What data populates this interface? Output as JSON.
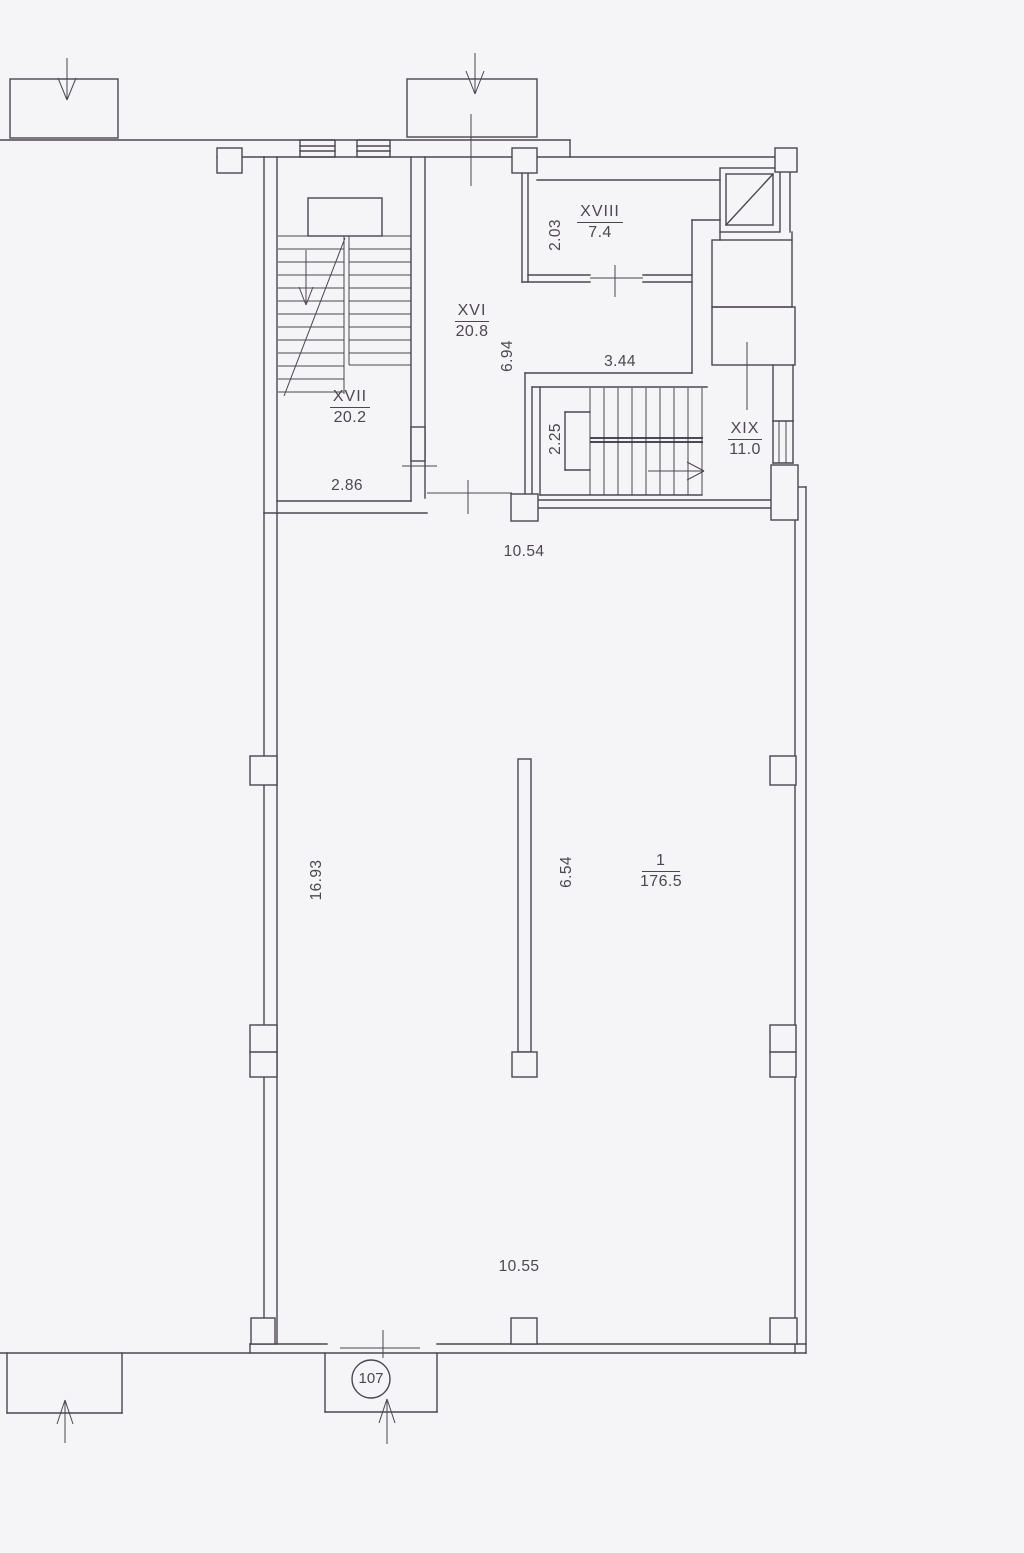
{
  "drawing": {
    "title": "floor-plan",
    "background": "#f5f4f6",
    "line_color": "#4b4650",
    "rooms": {
      "xvi": {
        "number": "XVI",
        "area": "20.8"
      },
      "xvii": {
        "number": "XVII",
        "area": "20.2"
      },
      "xviii": {
        "number": "XVIII",
        "area": "7.4"
      },
      "xix": {
        "number": "XIX",
        "area": "11.0"
      },
      "main": {
        "number": "1",
        "area": "176.5"
      }
    },
    "dimensions": {
      "d203": "2.03",
      "d344": "3.44",
      "d694": "6.94",
      "d225": "2.25",
      "d286": "2.86",
      "d1054": "10.54",
      "d1693": "16.93",
      "d654": "6.54",
      "d1055": "10.55"
    },
    "unit_number": "107"
  }
}
